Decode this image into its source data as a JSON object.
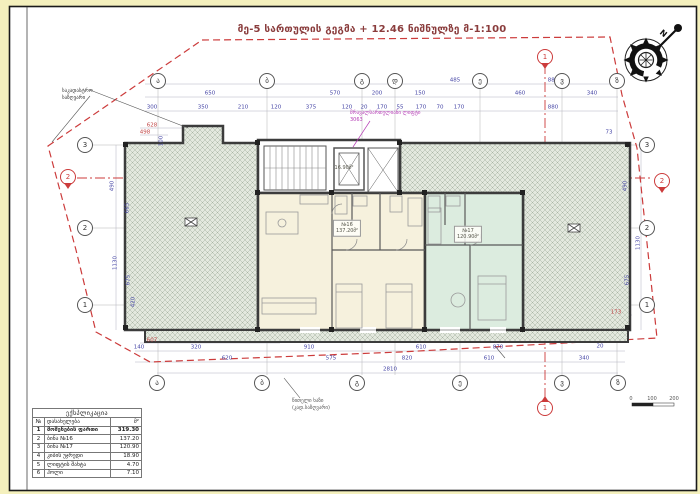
{
  "title": "მე-5 სართულის გეგმა + 12.46 ნიშნულზე მ-1:100",
  "compass": {
    "n": "N"
  },
  "annotations": {
    "cadastral": {
      "line1": "საკადასტრო",
      "line2": "საზღვარი"
    },
    "red_line": {
      "line1": "წითელი ხაზი",
      "line2": "(კად.საზღვარი)"
    },
    "elevator_note": {
      "line1": "მრავალსართულიანი ლიფტი",
      "line2": "3063"
    }
  },
  "rooms": [
    {
      "no": "№16",
      "area": "137.20მ²",
      "x": 347,
      "y": 228
    },
    {
      "no": "№17",
      "area": "120.90მ²",
      "x": 468,
      "y": 234
    },
    {
      "no": "",
      "area": "16.90მ²",
      "x": 344,
      "y": 168
    }
  ],
  "axis_bubbles": [
    {
      "l": "ა",
      "x": 158,
      "y": 81
    },
    {
      "l": "ბ",
      "x": 267,
      "y": 81
    },
    {
      "l": "გ",
      "x": 362,
      "y": 81
    },
    {
      "l": "დ",
      "x": 395,
      "y": 81
    },
    {
      "l": "ე",
      "x": 480,
      "y": 81
    },
    {
      "l": "ვ",
      "x": 562,
      "y": 81
    },
    {
      "l": "ზ",
      "x": 617,
      "y": 81
    },
    {
      "l": "ა",
      "x": 157,
      "y": 383
    },
    {
      "l": "ბ",
      "x": 262,
      "y": 383
    },
    {
      "l": "გ",
      "x": 357,
      "y": 383
    },
    {
      "l": "ე",
      "x": 460,
      "y": 383
    },
    {
      "l": "ვ",
      "x": 562,
      "y": 383
    },
    {
      "l": "ზ",
      "x": 618,
      "y": 383
    },
    {
      "l": "3",
      "x": 85,
      "y": 145
    },
    {
      "l": "2",
      "x": 85,
      "y": 228
    },
    {
      "l": "1",
      "x": 85,
      "y": 305
    },
    {
      "l": "3",
      "x": 647,
      "y": 145
    },
    {
      "l": "2",
      "x": 647,
      "y": 228
    },
    {
      "l": "1",
      "x": 647,
      "y": 305
    }
  ],
  "section_markers": [
    {
      "l": "1",
      "x": 545,
      "y": 57,
      "tri": "down"
    },
    {
      "l": "1",
      "x": 545,
      "y": 408,
      "tri": "up"
    },
    {
      "l": "2",
      "x": 68,
      "y": 177,
      "tri": "down"
    },
    {
      "l": "2",
      "x": 662,
      "y": 181,
      "tri": "down"
    }
  ],
  "dims": [
    {
      "t": "1605",
      "x": 267,
      "y": 81
    },
    {
      "t": "485",
      "x": 455,
      "y": 81
    },
    {
      "t": "880",
      "x": 553,
      "y": 81
    },
    {
      "t": "650",
      "x": 210,
      "y": 94
    },
    {
      "t": "570",
      "x": 335,
      "y": 94
    },
    {
      "t": "200",
      "x": 377,
      "y": 94
    },
    {
      "t": "150",
      "x": 420,
      "y": 94
    },
    {
      "t": "460",
      "x": 520,
      "y": 94
    },
    {
      "t": "340",
      "x": 592,
      "y": 94
    },
    {
      "t": "300",
      "x": 152,
      "y": 108
    },
    {
      "t": "350",
      "x": 203,
      "y": 108
    },
    {
      "t": "210",
      "x": 243,
      "y": 108
    },
    {
      "t": "120",
      "x": 276,
      "y": 108
    },
    {
      "t": "375",
      "x": 311,
      "y": 108
    },
    {
      "t": "120",
      "x": 347,
      "y": 108
    },
    {
      "t": "20",
      "x": 364,
      "y": 108
    },
    {
      "t": "170",
      "x": 382,
      "y": 108
    },
    {
      "t": "55",
      "x": 400,
      "y": 108
    },
    {
      "t": "170",
      "x": 421,
      "y": 108
    },
    {
      "t": "70",
      "x": 440,
      "y": 108
    },
    {
      "t": "170",
      "x": 459,
      "y": 108
    },
    {
      "t": "880",
      "x": 553,
      "y": 108
    },
    {
      "t": "140",
      "x": 139,
      "y": 348
    },
    {
      "t": "320",
      "x": 196,
      "y": 348
    },
    {
      "t": "910",
      "x": 309,
      "y": 348
    },
    {
      "t": "610",
      "x": 421,
      "y": 348
    },
    {
      "t": "870",
      "x": 498,
      "y": 348
    },
    {
      "t": "620",
      "x": 227,
      "y": 359
    },
    {
      "t": "575",
      "x": 331,
      "y": 359
    },
    {
      "t": "820",
      "x": 407,
      "y": 359
    },
    {
      "t": "610",
      "x": 489,
      "y": 359
    },
    {
      "t": "340",
      "x": 584,
      "y": 359
    },
    {
      "t": "2810",
      "x": 390,
      "y": 370
    },
    {
      "t": "100",
      "x": 162,
      "y": 141,
      "v": 1
    },
    {
      "t": "490",
      "x": 113,
      "y": 186,
      "v": 1
    },
    {
      "t": "665",
      "x": 128,
      "y": 208,
      "v": 1
    },
    {
      "t": "1130",
      "x": 116,
      "y": 263,
      "v": 1
    },
    {
      "t": "675",
      "x": 129,
      "y": 280,
      "v": 1
    },
    {
      "t": "420",
      "x": 134,
      "y": 302,
      "v": 1
    },
    {
      "t": "628",
      "x": 152,
      "y": 126,
      "c": "red"
    },
    {
      "t": "498",
      "x": 145,
      "y": 133,
      "c": "red"
    },
    {
      "t": "607",
      "x": 152,
      "y": 341,
      "c": "red"
    },
    {
      "t": "73",
      "x": 609,
      "y": 133
    },
    {
      "t": "490",
      "x": 626,
      "y": 186,
      "v": 1
    },
    {
      "t": "1130",
      "x": 639,
      "y": 243,
      "v": 1
    },
    {
      "t": "675",
      "x": 628,
      "y": 280,
      "v": 1
    },
    {
      "t": "173",
      "x": 616,
      "y": 313,
      "c": "red"
    },
    {
      "t": "20",
      "x": 600,
      "y": 347
    }
  ],
  "table": {
    "title": "ექსპლიკაცია",
    "headers": [
      "№",
      "დასახელება",
      "მ²"
    ],
    "rows": [
      [
        "1",
        "მოშენების ფართი",
        "319.30"
      ],
      [
        "2",
        "ბინა №16",
        "137.20"
      ],
      [
        "3",
        "ბინა №17",
        "120.90"
      ],
      [
        "4",
        "კიბის უჯრედი",
        "18.90"
      ],
      [
        "5",
        "ლიფტის შახტა",
        "4.70"
      ],
      [
        "6",
        "ჰოლი",
        "7.10"
      ]
    ]
  },
  "scalebar": {
    "labels": [
      "0",
      "100",
      "200"
    ],
    "xs": [
      631,
      652,
      674
    ],
    "y": 396
  },
  "colors": {
    "boundary_red": "#cc3b3b",
    "dim_blue": "#4646a6",
    "title_maroon": "#8a3c3c",
    "apt16_fill": "#f6f1dd",
    "apt17_fill": "#dcecdf",
    "hatch_bg": "#e3e8de",
    "wall": "#3c3c3c",
    "magenta_note": "#b43bb4",
    "page_margin": "#f4f0bd"
  }
}
